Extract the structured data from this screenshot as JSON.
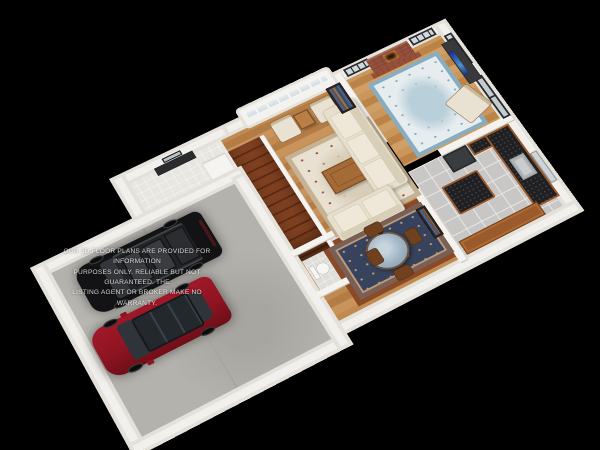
{
  "scene": {
    "type": "3d-floor-plan-render",
    "background_color": "#000000",
    "rooms": [
      "garage",
      "entry",
      "stairs",
      "powder-room",
      "living-room",
      "family-room",
      "dining-nook",
      "kitchen"
    ],
    "vehicles": [
      {
        "name": "black-suv",
        "color": "#131315"
      },
      {
        "name": "red-car",
        "color": "#8e1421"
      }
    ]
  },
  "watermark": {
    "line1": "OUR 3D FLOOR PLANS ARE PROVIDED FOR INFORMATION",
    "line2": "PURPOSES ONLY. RELIABLE BUT NOT GUARANTEED. THE",
    "line3": "LISTING AGENT OR BROKER MAKE NO WARRANTY.",
    "color": "#ffffff",
    "opacity": 0.8
  },
  "palette": {
    "wall_white": "#f2f0ec",
    "exterior_band": "#e4e1db",
    "hardwood": "#c08a51",
    "cherry_border": "#8a4a26",
    "garage_concrete": "#b4b2ad",
    "kitchen_tile": "#c8c7c5",
    "entry_tile": "#e8e6e1",
    "granite_counter": "#202023",
    "cabinet_wood": "#9a5a2a",
    "sofa_cream": "#e7dfcd",
    "living_rug": "#e8e1d1",
    "family_rug": "#e7edef",
    "dining_rug": "#37425d",
    "fireplace_brick": "#95503d",
    "fire_glow": "#f09030",
    "tv_screen": "#2746c8",
    "stair_carpet": "#7e4020",
    "suv_black": "#131315",
    "car_red": "#8e1421"
  }
}
